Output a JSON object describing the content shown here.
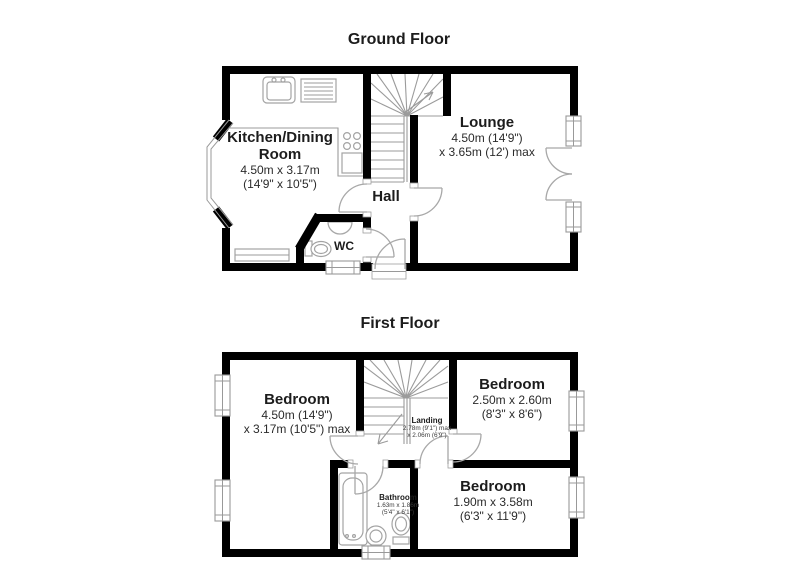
{
  "colors": {
    "background": "#ffffff",
    "wall": "#000000",
    "fixture_line": "#a8a8a8",
    "stair_line": "#9b9b9b",
    "window_line": "#999999",
    "room_text": "#1c1c1c",
    "dim_text": "#2b2b2b"
  },
  "floors": [
    {
      "title": "Ground Floor",
      "rooms": {
        "kitchen": {
          "name": "Kitchen/Dining Room",
          "dim1": "4.50m x 3.17m",
          "dim2": "(14'9\" x 10'5\")"
        },
        "lounge": {
          "name": "Lounge",
          "dim1": "4.50m (14'9\")",
          "dim2": "x 3.65m (12') max"
        },
        "hall": {
          "name": "Hall"
        },
        "wc": {
          "name": "WC"
        }
      }
    },
    {
      "title": "First Floor",
      "rooms": {
        "bedroom_left": {
          "name": "Bedroom",
          "dim1": "4.50m (14'9\")",
          "dim2": "x 3.17m (10'5\") max"
        },
        "bedroom_top_right": {
          "name": "Bedroom",
          "dim1": "2.50m x 2.60m",
          "dim2": "(8'3\" x 8'6\")"
        },
        "bedroom_bottom_right": {
          "name": "Bedroom",
          "dim1": "1.90m x 3.58m",
          "dim2": "(6'3\" x 11'9\")"
        },
        "landing": {
          "name": "Landing",
          "dim1": "2.78m (9'1\") max",
          "dim2": "x 2.06m (6'9\")"
        },
        "bathroom": {
          "name": "Bathroom",
          "dim1": "1.63m x 1.86m",
          "dim2": "(5'4\" x 6'1\")"
        }
      }
    }
  ]
}
